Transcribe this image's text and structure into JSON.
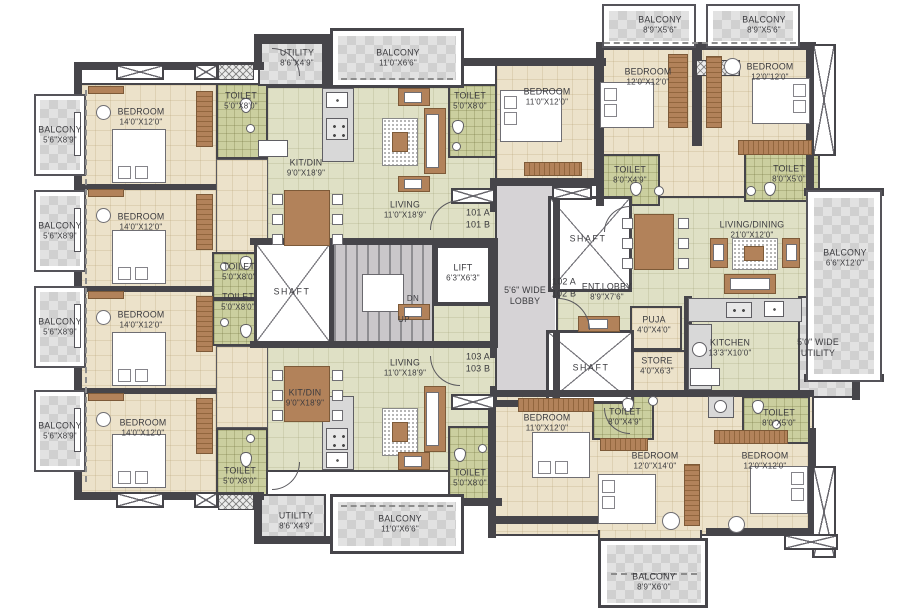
{
  "rooms": {
    "bal_l1": {
      "name": "BALCONY",
      "dims": "5'6\"X8'9\""
    },
    "bal_l2": {
      "name": "BALCONY",
      "dims": "5'6\"X8'9\""
    },
    "bal_l3": {
      "name": "BALCONY",
      "dims": "5'6\"X8'9\""
    },
    "bal_l4": {
      "name": "BALCONY",
      "dims": "5'6\"X8'9\""
    },
    "br_l1": {
      "name": "BEDROOM",
      "dims": "14'0\"X12'0\""
    },
    "br_l2": {
      "name": "BEDROOM",
      "dims": "14'0\"X12'0\""
    },
    "br_l3": {
      "name": "BEDROOM",
      "dims": "14'0\"X12'0\""
    },
    "br_l4": {
      "name": "BEDROOM",
      "dims": "14'0\"X12'0\""
    },
    "toi_tl": {
      "name": "TOILET",
      "dims": "5'0\"X8'0\""
    },
    "toi_ml1": {
      "name": "TOILET",
      "dims": "5'0\"X8'0\""
    },
    "toi_ml2": {
      "name": "TOILET",
      "dims": "5'0\"X8'0\""
    },
    "toi_bl": {
      "name": "TOILET",
      "dims": "5'0\"X8'0\""
    },
    "util_top": {
      "name": "UTILITY",
      "dims": "8'6\"X4'9\""
    },
    "bal_top": {
      "name": "BALCONY",
      "dims": "11'0\"X6'6\""
    },
    "toi_tc": {
      "name": "TOILET",
      "dims": "5'0\"X8'0\""
    },
    "kit_top": {
      "name": "KIT/DIN",
      "dims": "9'0\"X18'9\""
    },
    "liv_top": {
      "name": "LIVING",
      "dims": "11'0\"X18'9\""
    },
    "liv_bot": {
      "name": "LIVING",
      "dims": "11'0\"X18'9\""
    },
    "kit_bot": {
      "name": "KIT/DIN",
      "dims": "9'0\"X18'9\""
    },
    "toi_bc": {
      "name": "TOILET",
      "dims": "5'0\"X8'0\""
    },
    "util_bot": {
      "name": "UTILITY",
      "dims": "8'6\"X4'9\""
    },
    "bal_bot": {
      "name": "BALCONY",
      "dims": "11'0\"X6'6\""
    },
    "bal_rt1": {
      "name": "BALCONY",
      "dims": "8'9\"X5'6\""
    },
    "bal_rt2": {
      "name": "BALCONY",
      "dims": "8'9\"X5'6\""
    },
    "br_rtl": {
      "name": "BEDROOM",
      "dims": "12'0\"X12'0\""
    },
    "br_rtr": {
      "name": "BEDROOM",
      "dims": "12'0\"12'0\""
    },
    "br_tc": {
      "name": "BEDROOM",
      "dims": "11'0\"X12'0\""
    },
    "toi_r1": {
      "name": "TOILET",
      "dims": "8'0\"X4'9\""
    },
    "toi_r2": {
      "name": "TOILET",
      "dims": "8'0\"X5'0\""
    },
    "livdin": {
      "name": "LIVING/DINING",
      "dims": "21'0\"X12'0\""
    },
    "bal_r": {
      "name": "BALCONY",
      "dims": "6'6\"X12'0\""
    },
    "entlobby": {
      "name": "ENT.LOBBY",
      "dims": "8'9\"X7'6\""
    },
    "puja": {
      "name": "PUJA",
      "dims": "4'0\"X4'0\""
    },
    "store": {
      "name": "STORE",
      "dims": "4'0\"X6'3\""
    },
    "kitchen": {
      "name": "KITCHEN",
      "dims": "13'3\"X10'0\""
    },
    "util_r": {
      "name": "5'0\" WIDE",
      "dims": "UTILITY"
    },
    "toi_rb1": {
      "name": "TOILET",
      "dims": "8'0\"X4'9\""
    },
    "toi_rb2": {
      "name": "TOILET",
      "dims": "8'0\"X5'0\""
    },
    "br_bc": {
      "name": "BEDROOM",
      "dims": "11'0\"X12'0\""
    },
    "br_bm": {
      "name": "BEDROOM",
      "dims": "12'0\"X14'0\""
    },
    "br_br": {
      "name": "BEDROOM",
      "dims": "12'0\"X12'0\""
    },
    "bal_rb": {
      "name": "BALCONY",
      "dims": "8'9\"X6'0\""
    }
  },
  "core": {
    "shaft_left": "SHAFT",
    "shaft_top": "SHAFT",
    "shaft_bottom": "SHAFT",
    "lift": {
      "name": "LIFT",
      "dims": "6'3\"X6'3\""
    },
    "lobby": {
      "l1": "5'6\" WIDE",
      "l2": "LOBBY"
    },
    "stair": {
      "dn": "DN",
      "up": "UP"
    }
  },
  "units": {
    "u101": {
      "a": "101 A",
      "b": "101 B"
    },
    "u102": {
      "a": "102 A",
      "b": "102 B"
    },
    "u103": {
      "a": "103 A",
      "b": "103 B"
    }
  },
  "colors": {
    "wall": "#46454a",
    "bedroom_floor": "#ece2ca",
    "living_floor": "#dfe0c5",
    "toilet_floor": "#cbcf9f",
    "balcony_floor": "#dbdbdb",
    "lobby_floor": "#d6d3d6",
    "wood": "#b2825a"
  }
}
